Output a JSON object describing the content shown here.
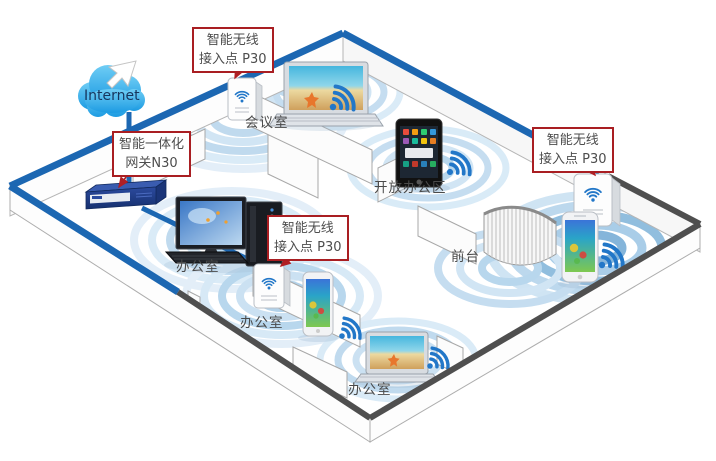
{
  "internet": {
    "label": "Internet"
  },
  "labels": {
    "gateway": {
      "line1": "智能一体化",
      "line2": "网关N30"
    },
    "ap": {
      "line1": "智能无线",
      "line2": "接入点 P30"
    }
  },
  "rooms": {
    "meeting_room": "会议室",
    "open_office": "开放办公区",
    "office_left": "办公室",
    "office_middle": "办公室",
    "office_bottom": "办公室",
    "reception": "前台"
  },
  "icons": {
    "internet": "cloud-icon",
    "gateway": "gateway-router-icon",
    "access_point": "access-point-icon",
    "wifi": "wifi-signal-icon",
    "laptop": "laptop-icon",
    "tablet": "tablet-icon",
    "desktop": "desktop-pc-icon",
    "smartphone": "smartphone-icon",
    "reception_desk": "reception-desk-icon",
    "pointer": "cursor-arrow-icon"
  },
  "colors": {
    "cable_blue": "#1c67b2",
    "wall_dark": "#4f4f4f",
    "label_border": "#a91e22",
    "arrow_red": "#b01f24",
    "wifi_blue": "#2277c8",
    "ripple_light": "#c9e0f2",
    "ripple_medium": "#aed0e9",
    "ripple_dark": "#7fb2d9",
    "cloud_blue": "#29a9e1",
    "text_gray": "#4d4d4d"
  }
}
